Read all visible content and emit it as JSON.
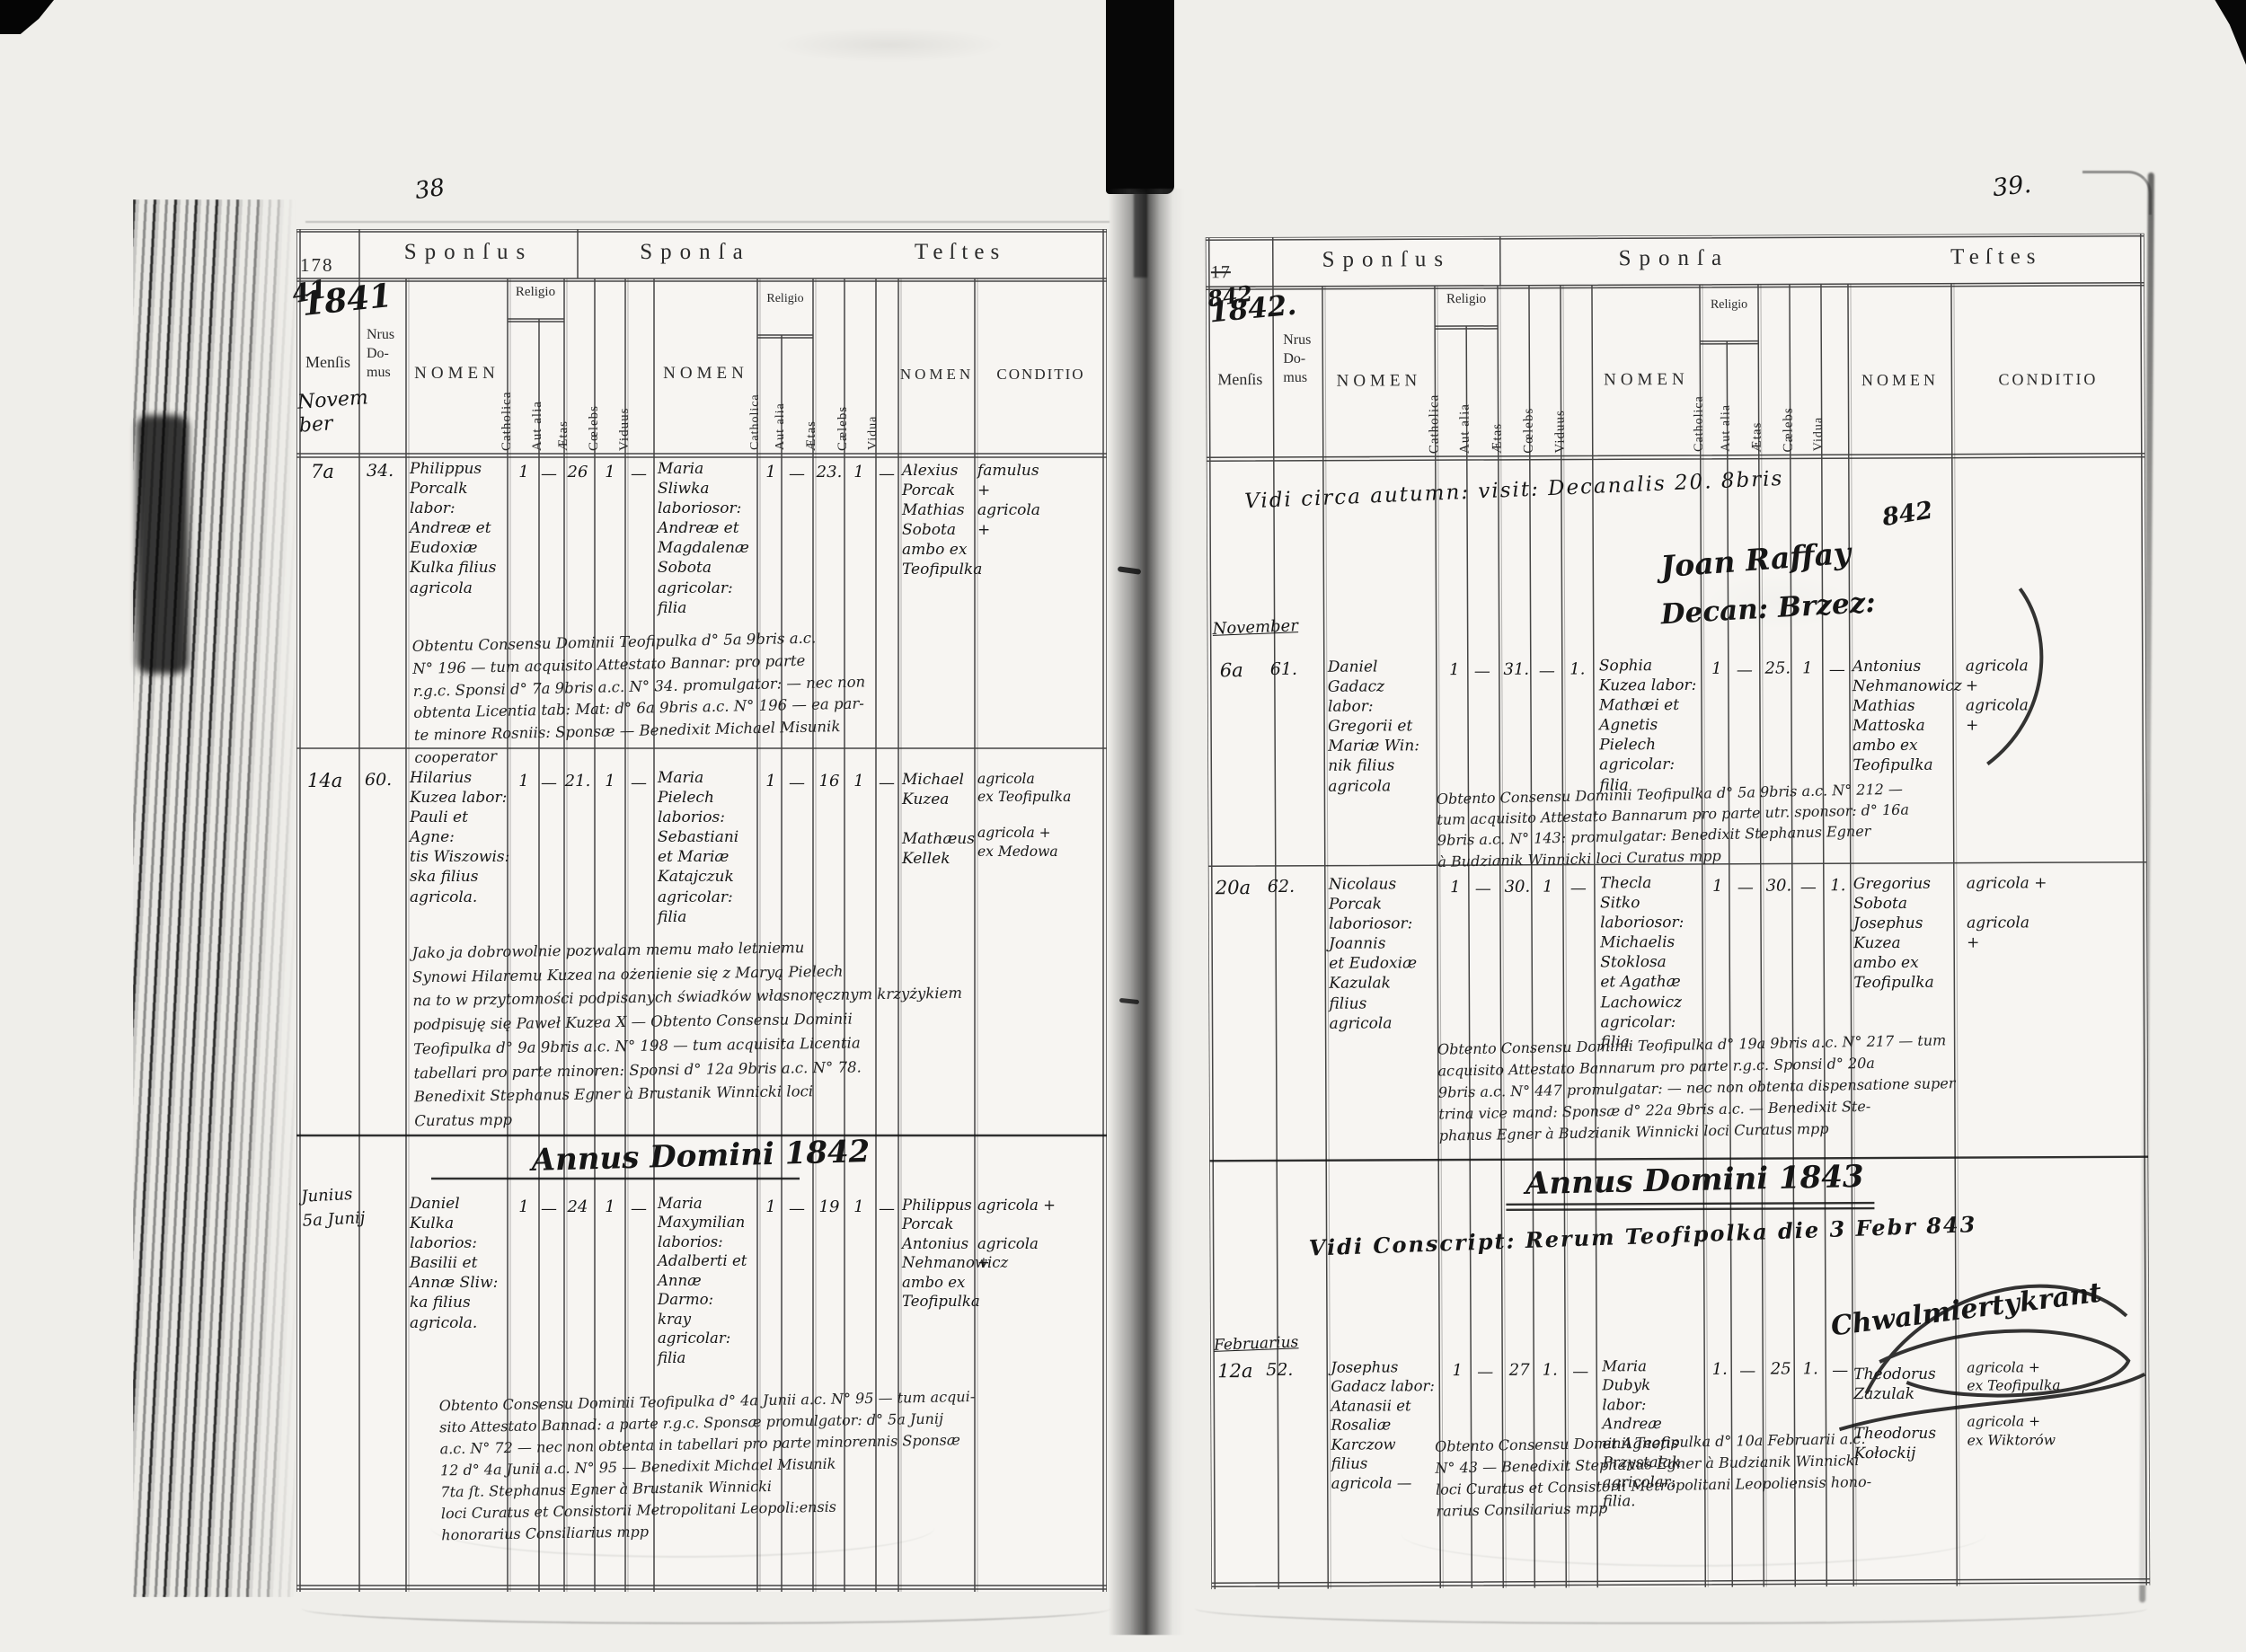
{
  "colors": {
    "ink": "#1b1b1b",
    "paper": "#efeeea",
    "ribbon": "#070707"
  },
  "document": {
    "left_page_number": "38",
    "right_page_number": "39."
  },
  "cols": {
    "sponsus": "Sponſus",
    "sponsa": "Sponſa",
    "testes": "Teſtes",
    "mensis": "Menſis",
    "nrus": "Nrus\nDo-\nmus",
    "nomen": "NOMEN",
    "religio": "Religio",
    "catholica": "Catholica",
    "aut_alia": "Aut alia",
    "aetas": "Ætas",
    "coelebs": "Cœlebs",
    "viduus": "Viduus",
    "caelebs_f": "Cælebs",
    "vidua": "Vidua",
    "conditio": "CONDITIO"
  },
  "left": {
    "page_number": "38",
    "year_printed": "178",
    "year_written": "41",
    "year_script": "1841",
    "month_script": "Novem\nber",
    "annus_heading": "Annus Domini 1842",
    "records": [
      {
        "day": "7a",
        "house": "34.",
        "groom": "Philippus\nPorcalk labor:\nAndreæ et\nEudoxiæ\nKulka filius\nagricola",
        "g": [
          "1",
          "—",
          "26",
          "1",
          "—"
        ],
        "bride": "Maria\nSliwka\nlaboriosor:\nAndreæ et\nMagdalenæ\nSobota\nagricolar:\nfilia",
        "b": [
          "1",
          "—",
          "23.",
          "1",
          "—"
        ],
        "witnesses": "Alexius\nPorcak\nMathias\nSobota\nambo ex Teofipulka",
        "conditio": "famulus\n      +\nagricola\n      +",
        "note": "Obtentu Consensu Dominii Teofipulka d° 5a 9bris a.c.\nN° 196 — tum acquisito Attestato Bannar: pro parte\nr.g.c. Sponsi d° 7a 9bris a.c. N° 34. promulgator: — nec non\nobtenta Licentia tab: Mat: d° 6a 9bris a.c. N° 196 — ea par-\nte minore Rosniis: Sponsæ — Benedixit Michael Misunik\ncooperator"
      },
      {
        "day": "14a",
        "house": "60.",
        "groom": "Hilarius\nKuzea labor:\nPauli et Agne:\ntis Wiszowis:\nska filius\nagricola.",
        "g": [
          "1",
          "—",
          "21.",
          "1",
          "—"
        ],
        "bride": "Maria\nPielech\nlaborios:\nSebastiani\net Mariæ\nKatajczuk\nagricolar:\nfilia",
        "b": [
          "1",
          "—",
          "16",
          "1",
          "—"
        ],
        "witnesses": "Michael\nKuzea\n\nMathæus\nKellek",
        "conditio": "agricola\nex Teofipulka\n\nagricola +\nex Medowa",
        "note": "Jako ja dobrowolnie pozwalam memu mało letniemu\nSynowi Hilaremu Kuzea na ożenienie się z Maryą Pielech\nna to w przytomności podpisanych świadków własnoręcznym krzyżykiem\npodpisuję się Paweł Kuzea X — Obtento Consensu Dominii\nTeofipulka d° 9a 9bris a.c. N° 198 — tum acquisita Licentia\ntabellari pro parte minoren: Sponsi d° 12a 9bris a.c. N° 78.\nBenedixit Stephanus Egner à Brustanik Winnicki loci\nCuratus mpp"
      },
      {
        "day": "Junius\n5a Junij",
        "house": "",
        "groom": "Daniel\nKulka\nlaborios:\nBasilii et\nAnnæ Sliw:\nka filius\nagricola.",
        "g": [
          "1",
          "—",
          "24",
          "1",
          "—"
        ],
        "bride": "Maria\nMaxymilian\nlaborios:\nAdalberti et\nAnnæ Darmo:\nkray agricolar:\nfilia",
        "b": [
          "1",
          "—",
          "19",
          "1",
          "—"
        ],
        "witnesses": "Philippus\nPorcak\nAntonius\nNehmanowicz\nambo ex Teofipulka",
        "conditio": "agricola +\n\nagricola\n      +",
        "note": "Obtento Consensu Dominii Teofipulka d° 4a Junii a.c. N° 95 — tum acqui-\nsito Attestato Bannad: a parte r.g.c. Sponsæ promulgator: d° 5a Junij\na.c. N° 72 — nec non obtenta in tabellari pro parte minorennis Sponsæ\n12 d° 4a Junii a.c. N° 95 — Benedixit Michael Misunik\n7ta ſt. Stephanus Egner à Brustanik Winnicki\nloci Curatus et Consistorii Metropolitani Leopoli:ensis\nhonorarius Consiliarius mpp"
      }
    ]
  },
  "right": {
    "page_number": "39.",
    "year_printed": "17",
    "year_written": "842",
    "year_script": "1842.",
    "visitation": "Vidi circa autumn: visit: Decanalis 20. 8bris",
    "visitation_year": "842",
    "sig1": "Joan Raffay",
    "sig2": "Decan: Brzez:",
    "month1": "November",
    "month2": "Februarius",
    "annus_heading": "Annus Domini 1843",
    "vidi2": "Vidi Conscript: Rerum Teofipolka die 3 Febr 843",
    "sig3": "Chwalmiertykrant",
    "records": [
      {
        "day": "6a",
        "house": "61.",
        "groom": "Daniel\nGadacz labor:\nGregorii et\nMariæ Win:\nnik filius\nagricola",
        "g": [
          "1",
          "—",
          "31.",
          "—",
          "1."
        ],
        "bride": "Sophia\nKuzea labor:\nMathæi et\nAgnetis\nPielech\nagricolar:\nfilia",
        "b": [
          "1",
          "—",
          "25.",
          "1",
          "—"
        ],
        "witnesses": "Antonius\nNehmanowicz\nMathias\nMattoska\nambo ex Teofipulka",
        "conditio": "agricola\n      +\nagricola\n      +",
        "note": "Obtento Consensu Dominii Teofipulka d° 5a 9bris a.c. N° 212 —\ntum acquisito Attestato Bannarum pro parte utr. sponsor: d° 16a\n9bris a.c. N° 143: promulgatar: Benedixit Stephanus Egner\nà Budzianik Winnicki loci Curatus mpp"
      },
      {
        "day": "20a",
        "house": "62.",
        "groom": "Nicolaus\nPorcak\nlaboriosor:\nJoannis\net Eudoxiæ\nKazulak\nfilius\nagricola",
        "g": [
          "1",
          "—",
          "30.",
          "1",
          "—"
        ],
        "bride": "Thecla\nSitko\nlaboriosor:\nMichaelis\nStoklosa\net Agathæ\nLachowicz\nagricolar:\nfilia",
        "b": [
          "1",
          "—",
          "30.",
          "—",
          "1."
        ],
        "witnesses": "Gregorius\nSobota\nJosephus\nKuzea\nambo ex Teofipulka",
        "conditio": "agricola +\n\nagricola\n      +",
        "note": "Obtento Consensu Dominii Teofipulka d° 19a 9bris a.c. N° 217 — tum\nacquisito Attestato Bannarum pro parte r.g.c. Sponsi d° 20a\n9bris a.c. N° 447 promulgatar: — nec non obtenta dispensatione super\ntrina vice mand: Sponsæ d° 22a 9bris a.c. — Benedixit Ste-\nphanus Egner à Budzianik Winnicki loci Curatus mpp"
      },
      {
        "day": "12a",
        "house": "52.",
        "groom": "Josephus\nGadacz labor:\nAtanasii et\nRosaliæ Karczow\nfilius\nagricola —",
        "g": [
          "1",
          "—",
          "27",
          "1.",
          "—"
        ],
        "bride": "Maria\nDubyk\nlabor: Andreæ\net Agnetis\nPrzystalak\nagricolar: filia.",
        "b": [
          "1.",
          "—",
          "25",
          "1.",
          "—"
        ],
        "witnesses": "Theodorus\nZazulak\n\nTheodorus\nKołockij",
        "conditio": "agricola +\nex Teofipulka\n\nagricola +\nex Wiktorów",
        "note": "Obtento Consensu Dominii Teofipulka d° 10a Februarii a.c.\nN° 43 — Benedixit Stephanus Egner à Budzianik Winnicki\nloci Curatus et Consistorii Metropolitani Leopoliensis hono-\nrarius Consiliarius mpp"
      }
    ]
  }
}
